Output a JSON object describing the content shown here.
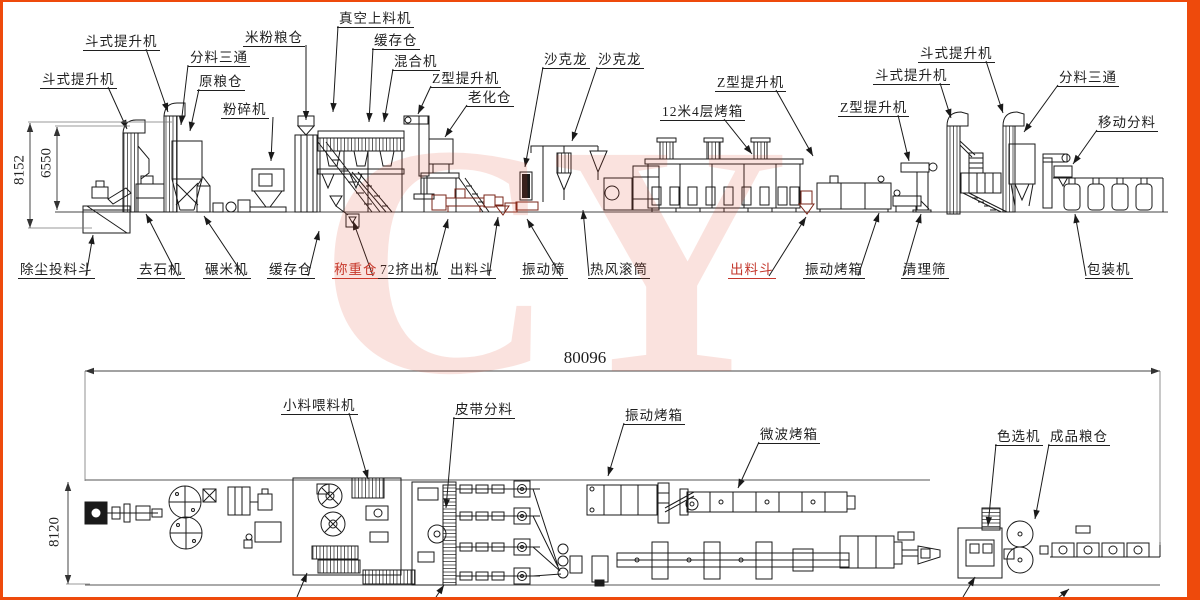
{
  "watermark": {
    "text": "CY"
  },
  "frame": {
    "color": "#ee4a0c"
  },
  "colors": {
    "ink": "#1a1a1a",
    "red_label": "#c3362b",
    "maroon": "#7a2518"
  },
  "views": {
    "top": "elevation-view",
    "bottom": "plan-view"
  },
  "dims": [
    {
      "text": "8152",
      "rot": true,
      "cx": 20,
      "cy": 170,
      "line": [
        30,
        123,
        30,
        228
      ],
      "ext": [
        [
          28,
          122,
          172,
          122
        ],
        [
          28,
          228,
          92,
          228
        ]
      ]
    },
    {
      "text": "6550",
      "rot": true,
      "cx": 47,
      "cy": 163,
      "line": [
        57,
        127,
        57,
        210
      ],
      "ext": [
        [
          55,
          126,
          130,
          126
        ]
      ]
    },
    {
      "text": "8120",
      "rot": true,
      "cx": 55,
      "cy": 532,
      "line": [
        68,
        482,
        68,
        584
      ],
      "ext": [
        [
          66,
          584,
          90,
          584
        ]
      ]
    },
    {
      "text": "80096",
      "rot": false,
      "cx": 585,
      "cy": 358,
      "line": [
        85,
        371,
        1160,
        371
      ],
      "ext": [
        [
          85,
          371,
          85,
          481
        ],
        [
          1160,
          371,
          1160,
          545
        ]
      ],
      "big": true
    }
  ],
  "labels": [
    {
      "t": "斗式提升机",
      "x": 83,
      "y": 35,
      "lead": [
        [
          146,
          49
        ],
        [
          168,
          112
        ]
      ]
    },
    {
      "t": "斗式提升机",
      "x": 40,
      "y": 73,
      "lead": [
        [
          108,
          87
        ],
        [
          127,
          129
        ]
      ]
    },
    {
      "t": "分料三通",
      "x": 188,
      "y": 51,
      "lead": [
        [
          188,
          65
        ],
        [
          181,
          125
        ]
      ]
    },
    {
      "t": "原粮仓",
      "x": 197,
      "y": 75,
      "lead": [
        [
          199,
          89
        ],
        [
          190,
          131
        ]
      ]
    },
    {
      "t": "粉碎机",
      "x": 221,
      "y": 103,
      "lead": [
        [
          273,
          117
        ],
        [
          271,
          161
        ]
      ]
    },
    {
      "t": "米粉粮仓",
      "x": 243,
      "y": 31,
      "lead": [
        [
          306,
          45
        ],
        [
          306,
          120
        ]
      ]
    },
    {
      "t": "真空上料机",
      "x": 337,
      "y": 12,
      "lead": [
        [
          338,
          26
        ],
        [
          333,
          112
        ]
      ]
    },
    {
      "t": "缓存仓",
      "x": 372,
      "y": 34,
      "lead": [
        [
          373,
          48
        ],
        [
          369,
          122
        ]
      ]
    },
    {
      "t": "混合机",
      "x": 392,
      "y": 55,
      "lead": [
        [
          393,
          69
        ],
        [
          384,
          122
        ]
      ]
    },
    {
      "t": "Z型提升机",
      "x": 430,
      "y": 72,
      "lead": [
        [
          431,
          86
        ],
        [
          418,
          114
        ]
      ]
    },
    {
      "t": "老化仓",
      "x": 466,
      "y": 91,
      "lead": [
        [
          467,
          105
        ],
        [
          445,
          137
        ]
      ]
    },
    {
      "t": "沙克龙",
      "x": 542,
      "y": 53,
      "lead": [
        [
          543,
          67
        ],
        [
          525,
          167
        ]
      ]
    },
    {
      "t": "沙克龙",
      "x": 596,
      "y": 53,
      "lead": [
        [
          597,
          67
        ],
        [
          572,
          141
        ]
      ]
    },
    {
      "t": "12米4层烤箱",
      "x": 660,
      "y": 105,
      "lead": [
        [
          724,
          119
        ],
        [
          752,
          154
        ]
      ]
    },
    {
      "t": "Z型提升机",
      "x": 715,
      "y": 76,
      "lead": [
        [
          776,
          90
        ],
        [
          813,
          156
        ]
      ]
    },
    {
      "t": "Z型提升机",
      "x": 838,
      "y": 101,
      "lead": [
        [
          898,
          115
        ],
        [
          909,
          161
        ]
      ]
    },
    {
      "t": "斗式提升机",
      "x": 873,
      "y": 69,
      "lead": [
        [
          940,
          83
        ],
        [
          951,
          118
        ]
      ]
    },
    {
      "t": "斗式提升机",
      "x": 918,
      "y": 47,
      "lead": [
        [
          986,
          61
        ],
        [
          1003,
          113
        ]
      ]
    },
    {
      "t": "分料三通",
      "x": 1057,
      "y": 71,
      "lead": [
        [
          1058,
          85
        ],
        [
          1024,
          132
        ]
      ]
    },
    {
      "t": "移动分料",
      "x": 1096,
      "y": 116,
      "lead": [
        [
          1097,
          130
        ],
        [
          1073,
          164
        ]
      ]
    },
    {
      "t": "除尘投料斗",
      "x": 18,
      "y": 263,
      "lead": [
        [
          86,
          276
        ],
        [
          93,
          235
        ]
      ]
    },
    {
      "t": "去石机",
      "x": 137,
      "y": 263,
      "lead": [
        [
          178,
          276
        ],
        [
          146,
          214
        ]
      ]
    },
    {
      "t": "碾米机",
      "x": 203,
      "y": 263,
      "lead": [
        [
          244,
          276
        ],
        [
          204,
          216
        ]
      ]
    },
    {
      "t": "缓存仓",
      "x": 267,
      "y": 263,
      "lead": [
        [
          308,
          276
        ],
        [
          319,
          231
        ]
      ]
    },
    {
      "t": "称重仓",
      "x": 332,
      "y": 263,
      "c": "#c3362b",
      "lead": [
        [
          373,
          276
        ],
        [
          353,
          221
        ]
      ]
    },
    {
      "t": "72挤出机",
      "x": 378,
      "y": 263,
      "lead": [
        [
          433,
          276
        ],
        [
          448,
          219
        ]
      ]
    },
    {
      "t": "出料斗",
      "x": 448,
      "y": 263,
      "lead": [
        [
          489,
          276
        ],
        [
          498,
          217
        ]
      ]
    },
    {
      "t": "振动筛",
      "x": 520,
      "y": 263,
      "lead": [
        [
          561,
          276
        ],
        [
          527,
          219
        ]
      ]
    },
    {
      "t": "热风滚筒",
      "x": 588,
      "y": 263,
      "lead": [
        [
          589,
          276
        ],
        [
          583,
          210
        ]
      ]
    },
    {
      "t": "出料斗",
      "x": 728,
      "y": 263,
      "c": "#c3362b",
      "lead": [
        [
          769,
          276
        ],
        [
          806,
          217
        ]
      ]
    },
    {
      "t": "振动烤箱",
      "x": 803,
      "y": 263,
      "lead": [
        [
          858,
          276
        ],
        [
          879,
          213
        ]
      ]
    },
    {
      "t": "清理筛",
      "x": 901,
      "y": 263,
      "lead": [
        [
          903,
          276
        ],
        [
          921,
          214
        ]
      ]
    },
    {
      "t": "包装机",
      "x": 1085,
      "y": 263,
      "lead": [
        [
          1086,
          276
        ],
        [
          1075,
          214
        ]
      ]
    },
    {
      "t": "小料喂料机",
      "x": 281,
      "y": 399,
      "lead": [
        [
          349,
          413
        ],
        [
          368,
          479
        ]
      ]
    },
    {
      "t": "皮带分料",
      "x": 453,
      "y": 403,
      "lead": [
        [
          454,
          417
        ],
        [
          446,
          508
        ]
      ]
    },
    {
      "t": "振动烤箱",
      "x": 623,
      "y": 409,
      "lead": [
        [
          624,
          423
        ],
        [
          608,
          476
        ]
      ]
    },
    {
      "t": "微波烤箱",
      "x": 758,
      "y": 428,
      "lead": [
        [
          759,
          442
        ],
        [
          738,
          488
        ]
      ]
    },
    {
      "t": "色选机",
      "x": 995,
      "y": 430,
      "lead": [
        [
          996,
          444
        ],
        [
          988,
          526
        ]
      ]
    },
    {
      "t": "成品粮仓",
      "x": 1048,
      "y": 430,
      "lead": [
        [
          1049,
          444
        ],
        [
          1035,
          519
        ]
      ]
    }
  ],
  "stubs": [
    [
      297,
      597,
      307,
      573
    ],
    [
      436,
      597,
      444,
      585
    ],
    [
      963,
      597,
      975,
      577
    ],
    [
      1058,
      598,
      1069,
      589
    ]
  ]
}
